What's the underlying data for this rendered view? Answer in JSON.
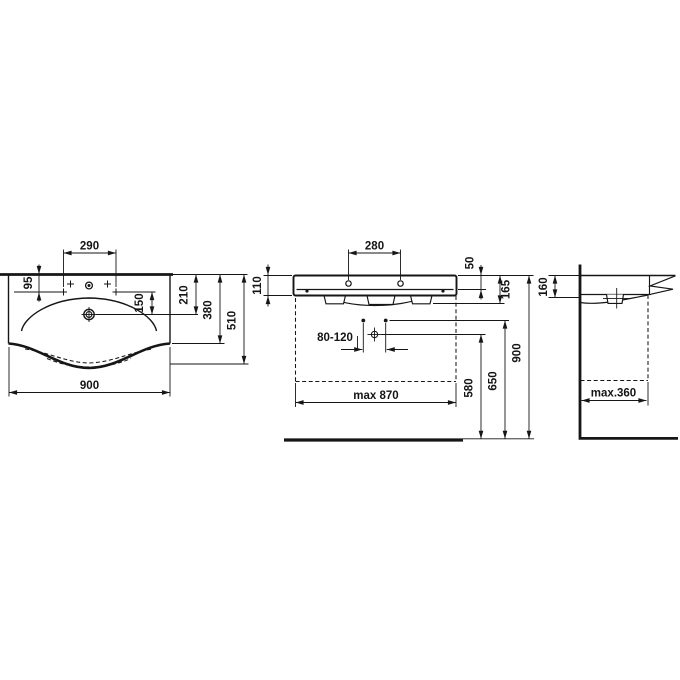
{
  "drawing": {
    "background_color": "#ffffff",
    "line_color": "#161616",
    "views": {
      "front_top": {
        "name": "washbasin-top-view",
        "dims": {
          "d290": "290",
          "d95": "95",
          "d150": "150",
          "d210": "210",
          "d380": "380",
          "d510": "510",
          "d900": "900"
        }
      },
      "elevation": {
        "name": "washbasin-front-elevation",
        "dims": {
          "d280": "280",
          "d110": "110",
          "d50": "50",
          "d165": "165",
          "d80_120": "80-120",
          "dmax870": "max 870",
          "d580": "580",
          "d650": "650",
          "d900": "900"
        }
      },
      "side": {
        "name": "washbasin-side-view",
        "dims": {
          "d160": "160",
          "dmax360": "max.360"
        }
      }
    }
  }
}
